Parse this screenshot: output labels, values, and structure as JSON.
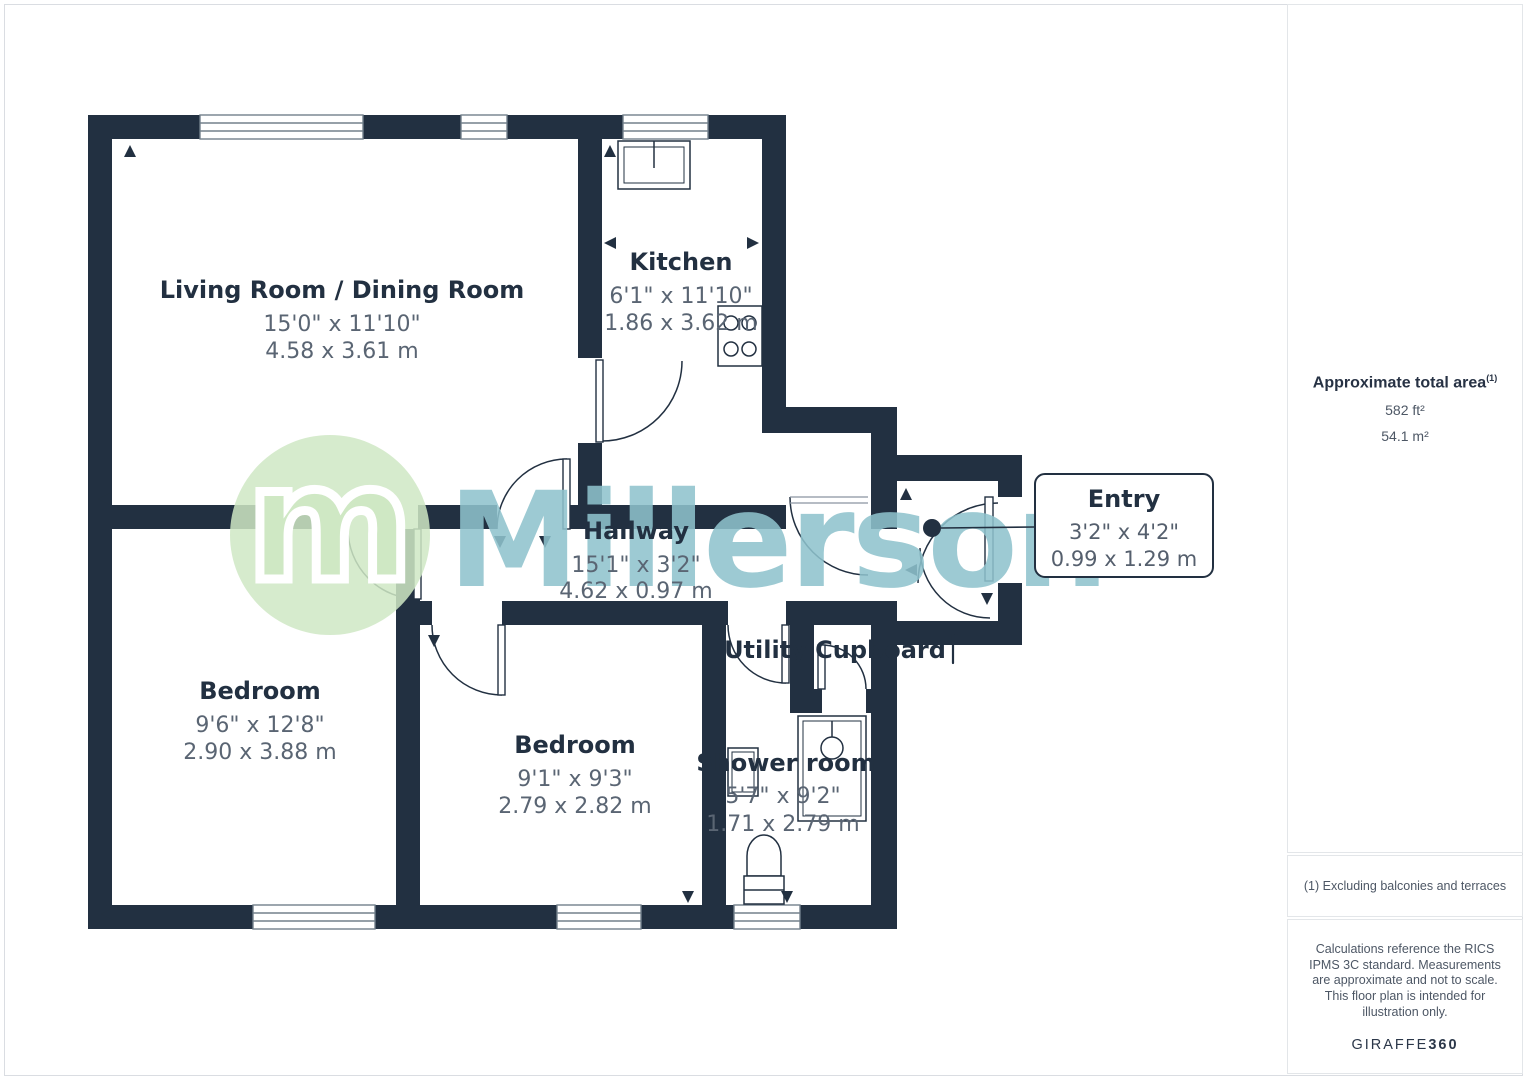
{
  "colors": {
    "wall": "#223041",
    "label": "#223041",
    "dimension_text": "#5a6573",
    "watermark_teal": "#8ec2cd",
    "logo_green": "#cfe8c4"
  },
  "watermark": {
    "brand": "Millerson",
    "logo_letter": "m"
  },
  "plan": {
    "rooms": [
      {
        "name": "Living Room / Dining Room",
        "dims_ft": "15'0\" x 11'10\"",
        "dims_m": "4.58 x 3.61 m"
      },
      {
        "name": "Kitchen",
        "dims_ft": "6'1\" x 11'10\"",
        "dims_m": "1.86 x 3.62 m"
      },
      {
        "name": "Hallway",
        "dims_ft": "15'1\" x 3'2\"",
        "dims_m": "4.62 x 0.97 m"
      },
      {
        "name": "Bedroom",
        "dims_ft": "9'6\" x 12'8\"",
        "dims_m": "2.90 x 3.88 m"
      },
      {
        "name": "Bedroom",
        "dims_ft": "9'1\" x 9'3\"",
        "dims_m": "2.79 x 2.82 m"
      },
      {
        "name": "Shower room",
        "dims_ft": "5'7\" x 9'2\"",
        "dims_m": "1.71 x 2.79 m"
      },
      {
        "name": "Utility Cupboard"
      },
      {
        "name": "Entry",
        "dims_ft": "3'2\" x 4'2\"",
        "dims_m": "0.99 x 1.29 m"
      }
    ]
  },
  "sidebar": {
    "area_title": "Approximate total area",
    "area_marker": "(1)",
    "area_imperial": "582 ft²",
    "area_metric": "54.1 m²",
    "footnote": "(1) Excluding balconies and terraces",
    "disclaimer": "Calculations reference the RICS IPMS 3C standard. Measurements are approximate and not to scale. This floor plan is intended for illustration only.",
    "brand_name": "GIRAFFE",
    "brand_number": "360"
  }
}
